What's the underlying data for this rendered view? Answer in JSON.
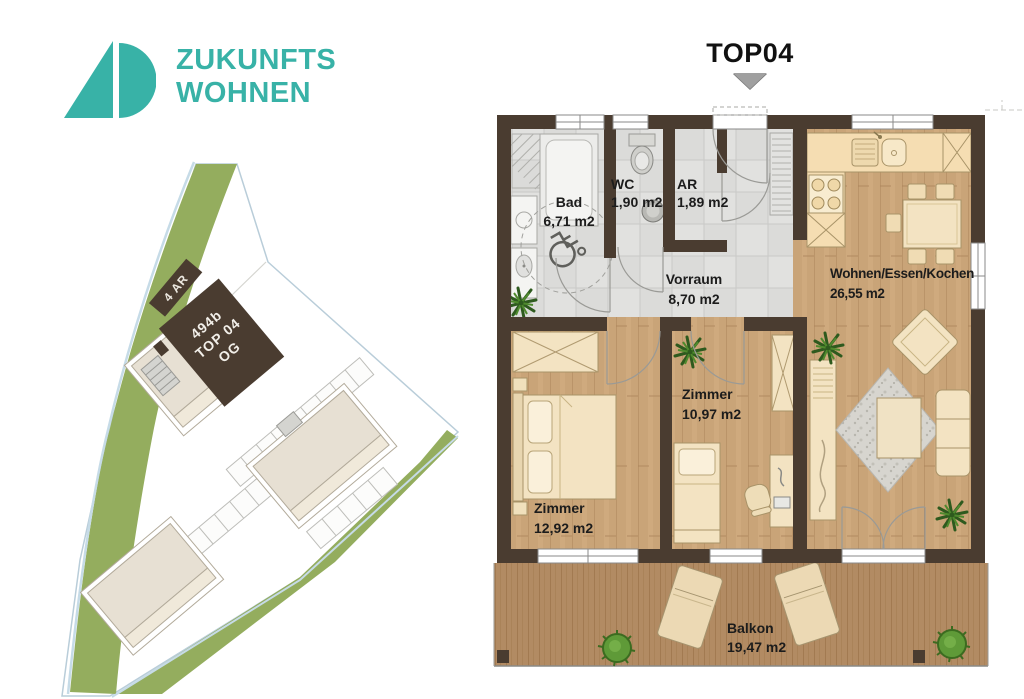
{
  "logo": {
    "line1": "ZUKUNFTS",
    "line2": "WOHNEN"
  },
  "title": {
    "label": "TOP04"
  },
  "site_plan": {
    "marker_4ar": "4 AR",
    "unit_line1": "494b",
    "unit_line2": "TOP 04",
    "unit_line3": "OG"
  },
  "floor_plan": {
    "rooms": {
      "bad": {
        "name": "Bad",
        "area": "6,71 m2"
      },
      "wc": {
        "name": "WC",
        "area": "1,90 m2"
      },
      "ar": {
        "name": "AR",
        "area": "1,89 m2"
      },
      "vorraum": {
        "name": "Vorraum",
        "area": "8,70 m2"
      },
      "wohnen": {
        "name": "Wohnen/Essen/Kochen",
        "area": "26,55 m2"
      },
      "zimmer_mid": {
        "name": "Zimmer",
        "area": "10,97 m2"
      },
      "zimmer_left": {
        "name": "Zimmer",
        "area": "12,92 m2"
      },
      "balkon": {
        "name": "Balkon",
        "area": "19,47 m2"
      }
    }
  },
  "colors": {
    "brand_teal": "#38b2a7",
    "wall_brown": "#4a3c30",
    "site_green": "#94ad5e",
    "wood_floor": "#c9a478",
    "tile_gray": "#dbdbd9"
  }
}
